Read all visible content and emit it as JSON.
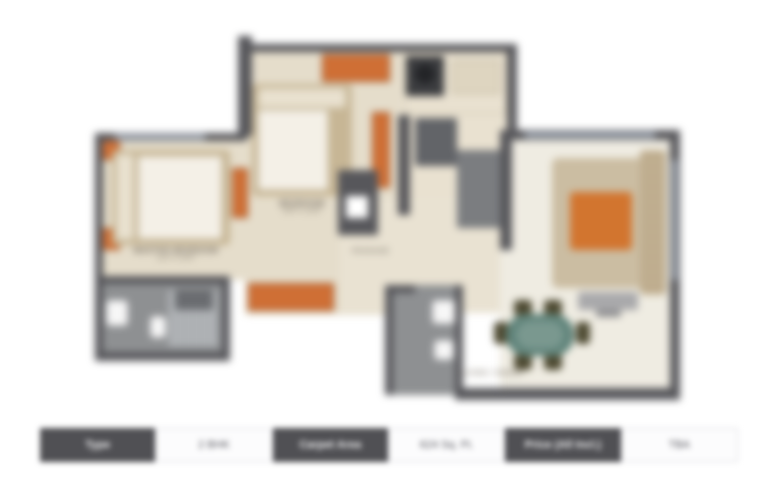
{
  "floor_plan": {
    "labels": {
      "master_bedroom": {
        "name": "MASTER BEDROOM",
        "dims": "11'0\" X 10'0\""
      },
      "bedroom2": {
        "name": "BEDROOM",
        "dims": "10'0\" X 10'0\""
      },
      "passage": {
        "name": "PASSAGE"
      },
      "living_dining": {
        "name": "LIVING / DINING"
      }
    },
    "colors": {
      "wall": "#57575b",
      "floor": "#e5ddcb",
      "accent_orange": "#cf6f35",
      "bathroom_gray": "#8e9092",
      "dining_table_teal": "#5f837a",
      "window_band": "#9ba3af"
    }
  },
  "details_table": {
    "cells": [
      {
        "label": "Type"
      },
      {
        "label": "2 BHK"
      },
      {
        "label": "Carpet Area"
      },
      {
        "label": "624 Sq. Ft."
      },
      {
        "label": "Price (All Incl.)"
      },
      {
        "label": "TBA"
      }
    ]
  }
}
